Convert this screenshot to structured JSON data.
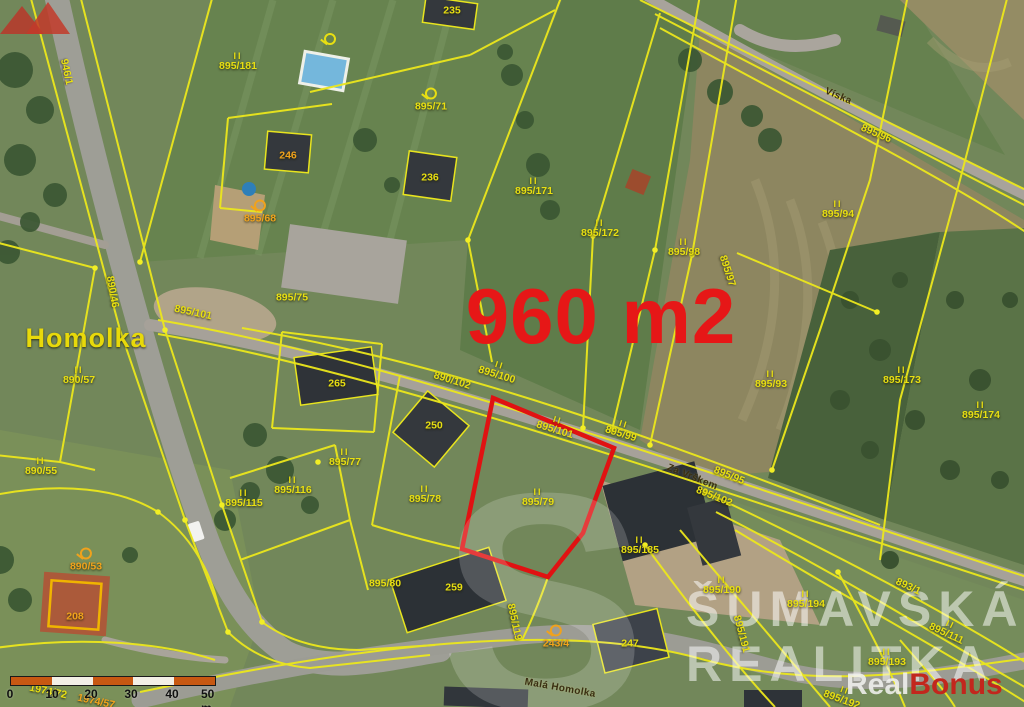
{
  "map": {
    "type": "cadastral-aerial-map",
    "area_highlight": "960 m2",
    "place_name": "Homolka",
    "street_names": [
      "Víska",
      "Za Vrškem",
      "Malá Homolka"
    ],
    "highlight_color": "#e01212",
    "parcel_line_color": "#ece71c",
    "label_yellow": "#e8df12",
    "label_orange": "#f0a21c"
  },
  "labels": [
    {
      "t": "946/1",
      "x": 66,
      "y": 72,
      "r": 78,
      "c": "y"
    },
    {
      "t": "235",
      "x": 452,
      "y": 11,
      "r": 0,
      "c": "y"
    },
    {
      "t": "895/181",
      "x": 238,
      "y": 62,
      "r": 0,
      "c": "y",
      "m": "II"
    },
    {
      "t": "895/71",
      "x": 431,
      "y": 100,
      "r": 0,
      "c": "y",
      "m": "flag"
    },
    {
      "t": "",
      "x": 330,
      "y": 40,
      "r": 0,
      "c": "y",
      "m": "flag"
    },
    {
      "t": "246",
      "x": 288,
      "y": 156,
      "r": 0,
      "c": "o"
    },
    {
      "t": "236",
      "x": 430,
      "y": 178,
      "r": 0,
      "c": "y"
    },
    {
      "t": "895/68",
      "x": 260,
      "y": 212,
      "r": 0,
      "c": "o",
      "m": "flag"
    },
    {
      "t": "895/171",
      "x": 534,
      "y": 187,
      "r": 0,
      "c": "y",
      "m": "II"
    },
    {
      "t": "895/172",
      "x": 600,
      "y": 229,
      "r": 0,
      "c": "y",
      "m": "II"
    },
    {
      "t": "Víska",
      "x": 838,
      "y": 97,
      "r": 23,
      "c": "road"
    },
    {
      "t": "895/96",
      "x": 876,
      "y": 134,
      "r": 23,
      "c": "y"
    },
    {
      "t": "895/94",
      "x": 838,
      "y": 210,
      "r": 0,
      "c": "y",
      "m": "II"
    },
    {
      "t": "895/98",
      "x": 684,
      "y": 248,
      "r": 0,
      "c": "y",
      "m": "II"
    },
    {
      "t": "895/97",
      "x": 727,
      "y": 271,
      "r": 72,
      "c": "y"
    },
    {
      "t": "895/75",
      "x": 292,
      "y": 298,
      "r": 0,
      "c": "y"
    },
    {
      "t": "Homolka",
      "x": 86,
      "y": 338,
      "r": 0,
      "c": "place"
    },
    {
      "t": "890/46",
      "x": 112,
      "y": 292,
      "r": 80,
      "c": "y"
    },
    {
      "t": "895/101",
      "x": 193,
      "y": 313,
      "r": 12,
      "c": "y"
    },
    {
      "t": "890/57",
      "x": 79,
      "y": 376,
      "r": 0,
      "c": "y",
      "m": "II"
    },
    {
      "t": "890/55",
      "x": 41,
      "y": 467,
      "r": 0,
      "c": "y",
      "m": "II"
    },
    {
      "t": "960 m2",
      "x": 601,
      "y": 317,
      "r": 0,
      "c": "area"
    },
    {
      "t": "265",
      "x": 337,
      "y": 384,
      "r": 0,
      "c": "y"
    },
    {
      "t": "890/102",
      "x": 452,
      "y": 381,
      "r": 17,
      "c": "y"
    },
    {
      "t": "895/100",
      "x": 498,
      "y": 371,
      "r": 17,
      "c": "y",
      "m": "II"
    },
    {
      "t": "895/101",
      "x": 556,
      "y": 426,
      "r": 17,
      "c": "y",
      "m": "II"
    },
    {
      "t": "895/99",
      "x": 622,
      "y": 430,
      "r": 17,
      "c": "y",
      "m": "II"
    },
    {
      "t": "250",
      "x": 434,
      "y": 426,
      "r": 0,
      "c": "y"
    },
    {
      "t": "895/93",
      "x": 771,
      "y": 380,
      "r": 0,
      "c": "y",
      "m": "II"
    },
    {
      "t": "895/173",
      "x": 902,
      "y": 376,
      "r": 0,
      "c": "y",
      "m": "II"
    },
    {
      "t": "895/174",
      "x": 981,
      "y": 411,
      "r": 0,
      "c": "y",
      "m": "II"
    },
    {
      "t": "895/77",
      "x": 345,
      "y": 458,
      "r": 0,
      "c": "y",
      "m": "II"
    },
    {
      "t": "895/115",
      "x": 244,
      "y": 499,
      "r": 0,
      "c": "y",
      "m": "II"
    },
    {
      "t": "895/116",
      "x": 293,
      "y": 486,
      "r": 0,
      "c": "y",
      "m": "II"
    },
    {
      "t": "895/78",
      "x": 425,
      "y": 495,
      "r": 0,
      "c": "y",
      "m": "II"
    },
    {
      "t": "895/79",
      "x": 538,
      "y": 498,
      "r": 0,
      "c": "y",
      "m": "II"
    },
    {
      "t": "Za Vrškem",
      "x": 692,
      "y": 478,
      "r": 22,
      "c": "road"
    },
    {
      "t": "895/95",
      "x": 729,
      "y": 476,
      "r": 22,
      "c": "y"
    },
    {
      "t": "895/102",
      "x": 714,
      "y": 497,
      "r": 22,
      "c": "y"
    },
    {
      "t": "890/53",
      "x": 86,
      "y": 560,
      "r": 0,
      "c": "o",
      "m": "flag"
    },
    {
      "t": "208",
      "x": 75,
      "y": 617,
      "r": 0,
      "c": "o"
    },
    {
      "t": "895/80",
      "x": 385,
      "y": 584,
      "r": 0,
      "c": "y"
    },
    {
      "t": "259",
      "x": 454,
      "y": 588,
      "r": 0,
      "c": "y"
    },
    {
      "t": "895/185",
      "x": 640,
      "y": 546,
      "r": 0,
      "c": "y",
      "m": "II"
    },
    {
      "t": "895/119",
      "x": 514,
      "y": 622,
      "r": 78,
      "c": "y"
    },
    {
      "t": "243/4",
      "x": 556,
      "y": 637,
      "r": 0,
      "c": "o",
      "m": "flag"
    },
    {
      "t": "247",
      "x": 630,
      "y": 644,
      "r": 0,
      "c": "y"
    },
    {
      "t": "895/190",
      "x": 722,
      "y": 586,
      "r": 0,
      "c": "y",
      "m": "II"
    },
    {
      "t": "895/194",
      "x": 806,
      "y": 600,
      "r": 0,
      "c": "y",
      "m": "II"
    },
    {
      "t": "895/191",
      "x": 741,
      "y": 634,
      "r": 75,
      "c": "y"
    },
    {
      "t": "893/1",
      "x": 908,
      "y": 587,
      "r": 25,
      "c": "y"
    },
    {
      "t": "895/111",
      "x": 948,
      "y": 630,
      "r": 25,
      "c": "y",
      "m": "II"
    },
    {
      "t": "895/193",
      "x": 887,
      "y": 658,
      "r": 0,
      "c": "y",
      "m": "II"
    },
    {
      "t": "895/192",
      "x": 843,
      "y": 696,
      "r": 20,
      "c": "y",
      "m": "II"
    },
    {
      "t": "Malá Homolka",
      "x": 560,
      "y": 689,
      "r": 10,
      "c": "road"
    },
    {
      "t": "1974/72",
      "x": 48,
      "y": 692,
      "r": 12,
      "c": "y"
    },
    {
      "t": "1974/57",
      "x": 96,
      "y": 702,
      "r": 12,
      "c": "o"
    }
  ],
  "watermark": {
    "line1": "ŠUMAVSKÁ",
    "line2": "REALITKA",
    "initial": "S"
  },
  "logo": {
    "real": "Real",
    "bonus": "Bonus"
  },
  "scalebar": {
    "segment_colors": [
      "#c75812",
      "#f3efe6",
      "#c75812",
      "#f3efe6",
      "#c75812"
    ],
    "ticks": [
      {
        "t": "0",
        "x": 10
      },
      {
        "t": "10",
        "x": 52
      },
      {
        "t": "20",
        "x": 91
      },
      {
        "t": "30",
        "x": 131
      },
      {
        "t": "40",
        "x": 172
      },
      {
        "t": "50 m",
        "x": 214
      }
    ]
  }
}
